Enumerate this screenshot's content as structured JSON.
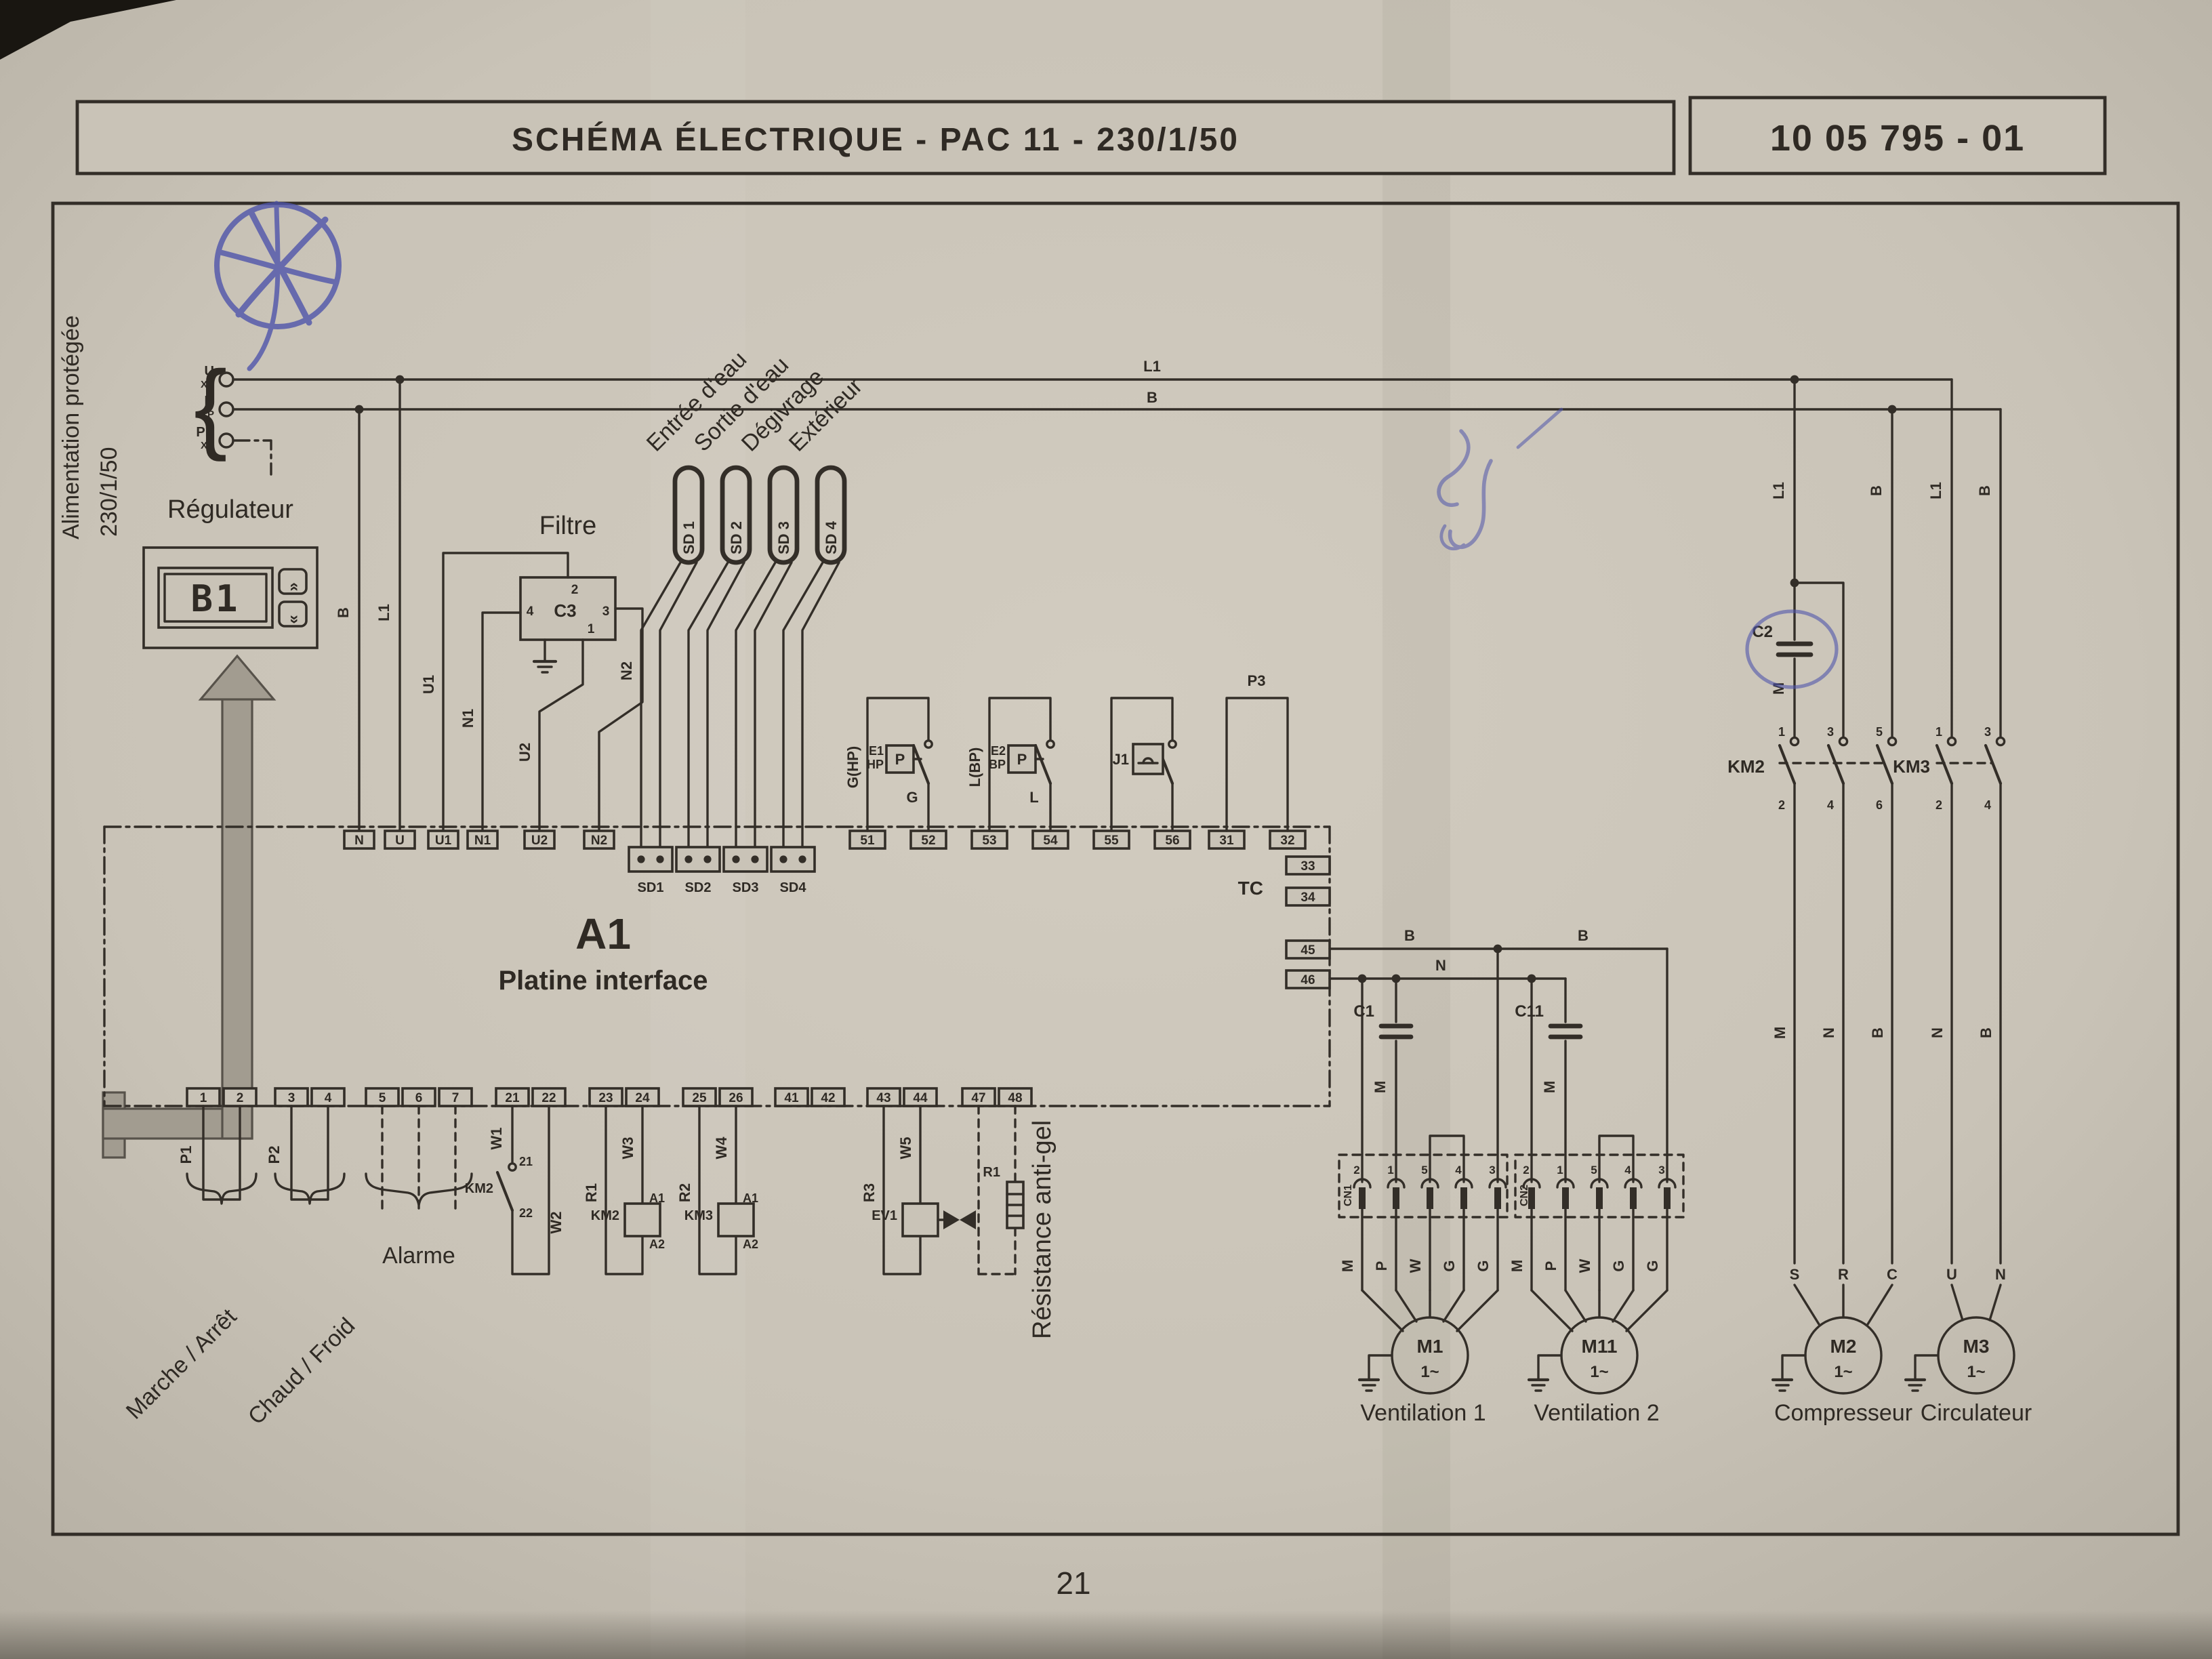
{
  "header": {
    "title": "SCHÉMA ÉLECTRIQUE  -  PAC 11 - 230/1/50",
    "doc_ref": "10 05 795 - 01"
  },
  "photo": {
    "page_number": "21"
  },
  "supply": {
    "line1": "Alimentation protégée",
    "line2": "230/1/50",
    "u": "U",
    "n": "N",
    "pe": "PE",
    "xp": "XP"
  },
  "buses": {
    "l1": "L1",
    "b": "B"
  },
  "regulator": {
    "label": "Régulateur",
    "display": "B1",
    "btn_up": "»",
    "btn_down": "«",
    "drop_b": "B",
    "drop_l1": "L1"
  },
  "filter": {
    "label": "Filtre",
    "ref": "C3",
    "pin2": "2",
    "pin4": "4",
    "pin3": "3",
    "pin1": "1",
    "u1": "U1",
    "n1": "N1",
    "u2": "U2",
    "n2": "N2"
  },
  "platine": {
    "ref": "A1",
    "name": "Platine interface",
    "top": [
      "N",
      "U",
      "U1",
      "N1",
      "U2",
      "N2"
    ],
    "mid": [
      "51",
      "52",
      "53",
      "54",
      "55",
      "56",
      "31",
      "32"
    ],
    "tc": "TC",
    "t33": "33",
    "t34": "34",
    "t45": "45",
    "t46": "46",
    "bottom": [
      "1",
      "2",
      "3",
      "4",
      "5",
      "6",
      "7",
      "21",
      "22",
      "23",
      "24",
      "25",
      "26",
      "41",
      "42",
      "43",
      "44",
      "47",
      "48"
    ]
  },
  "sensors": {
    "sd1": {
      "tag": "SD 1",
      "name": "Entrée d'eau",
      "label": "SD1"
    },
    "sd2": {
      "tag": "SD 2",
      "name": "Sortie d'eau",
      "label": "SD2"
    },
    "sd3": {
      "tag": "SD 3",
      "name": "Dégivrage",
      "label": "SD3"
    },
    "sd4": {
      "tag": "SD 4",
      "name": "Extérieur",
      "label": "SD4"
    }
  },
  "hp": {
    "wire": "G(HP)",
    "ref": "E1",
    "sub": "HP",
    "p": "P",
    "out": "G"
  },
  "bp": {
    "wire": "L(BP)",
    "ref": "E2",
    "sub": "BP",
    "p": "P",
    "out": "L"
  },
  "flow": {
    "ref": "J1"
  },
  "p3": {
    "ref": "P3"
  },
  "outputs": {
    "b1": "B",
    "b2": "B",
    "n": "N"
  },
  "controls": {
    "p1": "P1",
    "p2": "P2",
    "marche": "Marche / Arrêt",
    "chaud": "Chaud / Froid",
    "alarme": "Alarme",
    "aux": {
      "w1": "W1",
      "km": "KM2",
      "t21": "21",
      "t22": "22",
      "w2": "W2"
    },
    "km2": {
      "wl": "R1",
      "wr": "W3",
      "name": "KM2",
      "a1": "A1",
      "a2": "A2"
    },
    "km3": {
      "wl": "R2",
      "wr": "W4",
      "name": "KM3",
      "a1": "A1",
      "a2": "A2"
    },
    "ev1": {
      "wl": "R3",
      "wr": "W5",
      "name": "EV1"
    },
    "antigel": {
      "ref": "R1",
      "label": "Résistance anti-gel"
    }
  },
  "fan1": {
    "connector": "CN1",
    "pins": [
      "2",
      "1",
      "5",
      "4",
      "3"
    ],
    "cap": "C1",
    "cap_wire": "M",
    "wires": [
      "M",
      "P",
      "W",
      "G",
      "G"
    ],
    "motor": "M1",
    "phase": "1~",
    "name": "Ventilation 1"
  },
  "fan2": {
    "connector": "CN2",
    "pins": [
      "2",
      "1",
      "5",
      "4",
      "3"
    ],
    "cap": "C11",
    "cap_wire": "M",
    "wires": [
      "M",
      "P",
      "W",
      "G",
      "G"
    ],
    "motor": "M11",
    "phase": "1~",
    "name": "Ventilation 2"
  },
  "compressor": {
    "drop1": "L1",
    "drop2": "B",
    "cap": "C2",
    "cap_wire": "M",
    "km": "KM2",
    "top": [
      "1",
      "3",
      "5"
    ],
    "bot": [
      "2",
      "4",
      "6"
    ],
    "wires": [
      "M",
      "N",
      "B"
    ],
    "terms": [
      "S",
      "R",
      "C"
    ],
    "motor": "M2",
    "phase": "1~",
    "name": "Compresseur"
  },
  "circulator": {
    "drop1": "L1",
    "drop2": "B",
    "km": "KM3",
    "top": [
      "1",
      "3"
    ],
    "bot": [
      "2",
      "4"
    ],
    "wires": [
      "N",
      "B"
    ],
    "terms": [
      "U",
      "N"
    ],
    "motor": "M3",
    "phase": "1~",
    "name": "Circulateur"
  }
}
